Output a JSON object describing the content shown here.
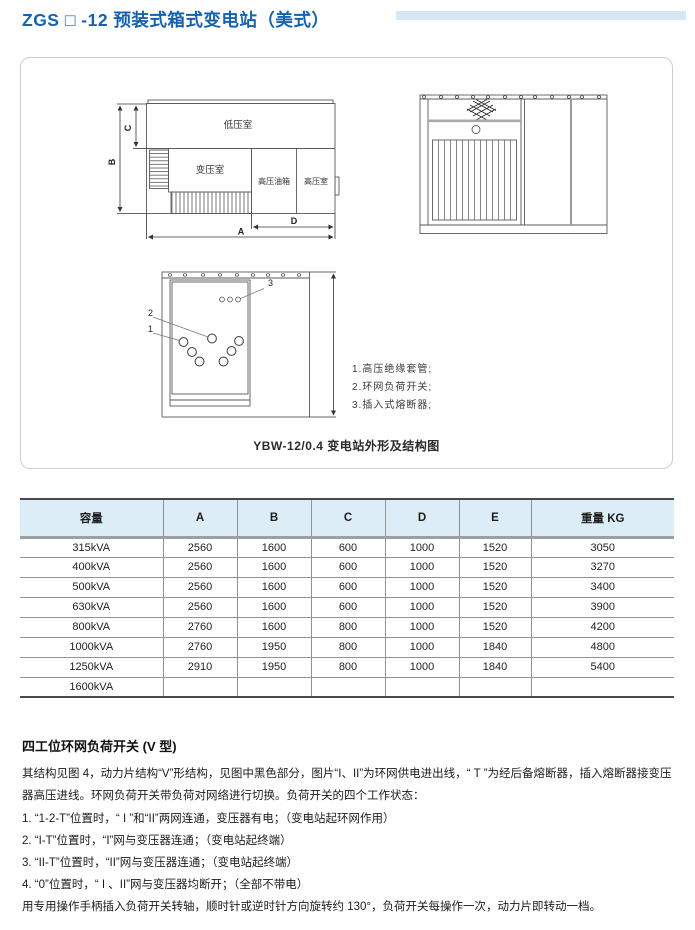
{
  "page": {
    "title": "ZGS □ -12 预装式箱式变电站（美式）"
  },
  "figure": {
    "caption": "YBW-12/0.4 变电站外形及结构图",
    "plan": {
      "rooms": {
        "low_voltage": "低压室",
        "transformer": "变压室",
        "hv_oil_tank": "高压油箱",
        "hv_room": "高压室"
      },
      "dims": {
        "a": "A",
        "b": "B",
        "c": "C",
        "d": "D"
      }
    },
    "callouts": [
      "1",
      "2",
      "3"
    ],
    "legend": [
      "1.高压绝缘套管;",
      "2.环网负荷开关;",
      "3.插入式熔断器;"
    ]
  },
  "table": {
    "headers": [
      "容量",
      "A",
      "B",
      "C",
      "D",
      "E",
      "重量 KG"
    ],
    "rows": [
      [
        "315kVA",
        "2560",
        "1600",
        "600",
        "1000",
        "1520",
        "3050"
      ],
      [
        "400kVA",
        "2560",
        "1600",
        "600",
        "1000",
        "1520",
        "3270"
      ],
      [
        "500kVA",
        "2560",
        "1600",
        "600",
        "1000",
        "1520",
        "3400"
      ],
      [
        "630kVA",
        "2560",
        "1600",
        "600",
        "1000",
        "1520",
        "3900"
      ],
      [
        "800kVA",
        "2760",
        "1600",
        "800",
        "1000",
        "1520",
        "4200"
      ],
      [
        "1000kVA",
        "2760",
        "1950",
        "800",
        "1000",
        "1840",
        "4800"
      ],
      [
        "1250kVA",
        "2910",
        "1950",
        "800",
        "1000",
        "1840",
        "5400"
      ],
      [
        "1600kVA",
        "",
        "",
        "",
        "",
        "",
        ""
      ]
    ]
  },
  "notes": {
    "heading": "四工位环网负荷开关 (V 型)",
    "paragraph": "其结构见图 4，动力片结构“V”形结构，见图中黑色部分，图片“I、II”为环网供电进出线，“ T ”为经后备熔断器，插入熔断器接变压器高压进线。环网负荷开关带负荷对网络进行切换。负荷开关的四个工作状态：",
    "items": [
      "1. “1-2-T”位置时，“ I ”和“II”两网连通，变压器有电；（变电站起环网作用）",
      "2. “I-T”位置时，“I”网与变压器连通；（变电站起终端）",
      "3. “II-T”位置时，“II”网与变压器连通；（变电站起终端）",
      "4. “0”位置时，“ I 、II”网与变压器均断开；（全部不带电）"
    ],
    "footer": "用专用操作手柄插入负荷开关转轴，顺时针或逆时针方向旋转约 130°，负荷开关每操作一次，动力片即转动一档。"
  },
  "colors": {
    "accent_blue": "#1761ae",
    "title_bar": "#d5e8f5",
    "table_header_bg": "#ddedf7",
    "panel_border": "#c9ced2"
  }
}
